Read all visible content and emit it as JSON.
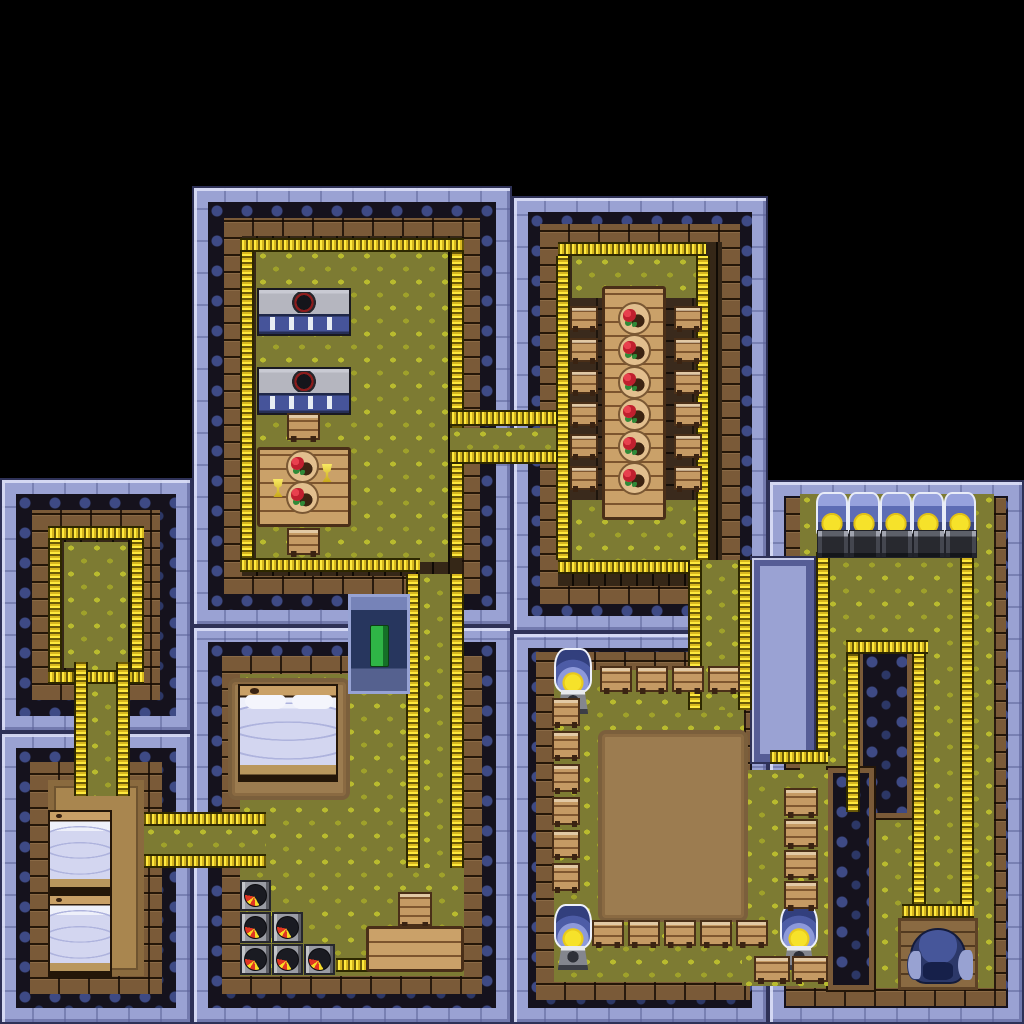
{
  "meta": {
    "app": "tile-rpg-interior-map",
    "description": "Top-down pixel-art interior of a multi-room building on black background",
    "canvas": {
      "width": 1024,
      "height": 1024,
      "background": "#000000"
    }
  },
  "palette": {
    "wall_light": "#9aa2d3",
    "wall_ornate_bg": "#15121d",
    "wall_ornate_swirl": "#3e4a85",
    "brick": "#7a5a38",
    "floor_shadow": "#352717",
    "floor_green": "#7d7b33",
    "leaf": "#b9bb2e",
    "fence_yellow": "#ffe93d",
    "wood": "#caa169",
    "floor_tan": "#a9864f",
    "stove_base_blue": "#46549a",
    "food_red": "#c01f2e",
    "food_green": "#2f8a38",
    "bed_sheet": "#d3d6f0",
    "flame_red": "#e03522",
    "flame_yellow": "#f7dc25",
    "lamp_glass": "#8d99da",
    "lamp_bulb": "#f6e22a",
    "book_green": "#2fb546",
    "throne_blue": "#2c3869"
  },
  "rooms": [
    {
      "id": "kitchen",
      "name": "kitchen-dining-room",
      "x": 192,
      "y": 186,
      "w": 320,
      "h": 440,
      "wall": [
        48,
        48,
        48,
        48
      ],
      "floor": "dark+green"
    },
    {
      "id": "dining",
      "name": "dining-hall",
      "x": 512,
      "y": 196,
      "w": 256,
      "h": 436,
      "wall": [
        44,
        44,
        44,
        44
      ],
      "floor": "dark+green"
    },
    {
      "id": "storage",
      "name": "small-storage-room",
      "x": 0,
      "y": 478,
      "w": 192,
      "h": 254,
      "wall": [
        48,
        48,
        48,
        48
      ],
      "floor": "dark+green"
    },
    {
      "id": "twinbeds",
      "name": "twin-bedroom",
      "x": 0,
      "y": 732,
      "w": 192,
      "h": 292,
      "wall": [
        46,
        46,
        46,
        46
      ],
      "floor": "tan"
    },
    {
      "id": "masterbed",
      "name": "master-bedroom",
      "x": 192,
      "y": 626,
      "w": 320,
      "h": 398,
      "wall": [
        46,
        46,
        46,
        46
      ],
      "floor": "green"
    },
    {
      "id": "dojo",
      "name": "training-hall",
      "x": 512,
      "y": 632,
      "w": 256,
      "h": 392,
      "wall": [
        36,
        22,
        40,
        40
      ],
      "floor": "green"
    },
    {
      "id": "machines",
      "name": "machine-room",
      "x": 768,
      "y": 480,
      "w": 256,
      "h": 544,
      "wall": [
        12,
        28,
        34,
        30
      ],
      "floor": "green"
    }
  ],
  "wall_patches": [
    {
      "name": "machine-room-west-wall",
      "cls": "wall-side",
      "x": 750,
      "y": 556,
      "w": 66,
      "h": 208
    },
    {
      "name": "interior-wall-pillar",
      "cls": "wall-patch",
      "x": 858,
      "y": 648,
      "w": 54,
      "h": 170
    },
    {
      "name": "interior-wall-band",
      "cls": "wall-patch",
      "x": 828,
      "y": 768,
      "w": 46,
      "h": 222
    }
  ],
  "floor_patches": [
    {
      "name": "dojo-east-wing-floor",
      "x": 742,
      "y": 770,
      "w": 86,
      "h": 216
    }
  ],
  "corridors": [
    {
      "name": "corridor-kitchen-to-dining-hall",
      "x": 450,
      "y": 428,
      "w": 112,
      "h": 22
    },
    {
      "name": "corridor-kitchen-to-master-bedroom",
      "x": 420,
      "y": 574,
      "w": 30,
      "h": 294
    },
    {
      "name": "corridor-dining-hall-to-dojo",
      "x": 702,
      "y": 560,
      "w": 36,
      "h": 150
    },
    {
      "name": "corridor-storage-to-twin-bedroom",
      "x": 88,
      "y": 662,
      "w": 28,
      "h": 134
    },
    {
      "name": "corridor-twin-bedroom-to-master-bedroom",
      "x": 144,
      "y": 826,
      "w": 122,
      "h": 28
    }
  ],
  "fences": [
    {
      "x": 240,
      "y": 238,
      "w": 224,
      "h": 14
    },
    {
      "x": 240,
      "y": 252,
      "w": 14,
      "h": 306
    },
    {
      "x": 450,
      "y": 252,
      "w": 14,
      "h": 176
    },
    {
      "x": 450,
      "y": 452,
      "w": 14,
      "h": 106
    },
    {
      "x": 240,
      "y": 558,
      "w": 180,
      "h": 14
    },
    {
      "x": 450,
      "y": 410,
      "w": 112,
      "h": 16
    },
    {
      "x": 450,
      "y": 450,
      "w": 112,
      "h": 14
    },
    {
      "x": 406,
      "y": 574,
      "w": 14,
      "h": 294
    },
    {
      "x": 450,
      "y": 574,
      "w": 14,
      "h": 294
    },
    {
      "x": 558,
      "y": 242,
      "w": 148,
      "h": 14
    },
    {
      "x": 556,
      "y": 256,
      "w": 14,
      "h": 304
    },
    {
      "x": 696,
      "y": 256,
      "w": 14,
      "h": 304
    },
    {
      "x": 558,
      "y": 560,
      "w": 142,
      "h": 14
    },
    {
      "x": 688,
      "y": 560,
      "w": 14,
      "h": 150
    },
    {
      "x": 738,
      "y": 560,
      "w": 14,
      "h": 150
    },
    {
      "x": 48,
      "y": 526,
      "w": 96,
      "h": 14
    },
    {
      "x": 48,
      "y": 540,
      "w": 14,
      "h": 130
    },
    {
      "x": 130,
      "y": 540,
      "w": 14,
      "h": 130
    },
    {
      "x": 48,
      "y": 670,
      "w": 96,
      "h": 14
    },
    {
      "x": 74,
      "y": 662,
      "w": 14,
      "h": 134
    },
    {
      "x": 116,
      "y": 662,
      "w": 14,
      "h": 134
    },
    {
      "x": 144,
      "y": 812,
      "w": 122,
      "h": 14
    },
    {
      "x": 144,
      "y": 854,
      "w": 122,
      "h": 14
    },
    {
      "x": 336,
      "y": 958,
      "w": 34,
      "h": 14
    },
    {
      "x": 816,
      "y": 552,
      "w": 14,
      "h": 204
    },
    {
      "x": 770,
      "y": 750,
      "w": 58,
      "h": 14
    },
    {
      "x": 960,
      "y": 552,
      "w": 14,
      "h": 372
    },
    {
      "x": 846,
      "y": 640,
      "w": 82,
      "h": 14
    },
    {
      "x": 846,
      "y": 654,
      "w": 14,
      "h": 158
    },
    {
      "x": 912,
      "y": 654,
      "w": 14,
      "h": 268
    },
    {
      "x": 902,
      "y": 904,
      "w": 72,
      "h": 14
    }
  ],
  "decor": [
    {
      "type": "darkwood",
      "name": "dining-hall-dark-floor",
      "x": 566,
      "y": 298,
      "w": 142,
      "h": 202
    },
    {
      "type": "rug",
      "name": "master-bed-rug",
      "x": 228,
      "y": 678,
      "w": 122,
      "h": 122
    },
    {
      "type": "arena",
      "name": "sparring-arena-dirt",
      "x": 598,
      "y": 730,
      "w": 150,
      "h": 192
    }
  ],
  "furniture": [
    {
      "type": "stove",
      "name": "stove-counter",
      "x": 257,
      "y": 288,
      "w": 94,
      "h": 48
    },
    {
      "type": "stove",
      "name": "stove-counter",
      "x": 257,
      "y": 367,
      "w": 94,
      "h": 48
    },
    {
      "type": "seat",
      "name": "chair",
      "x": 287,
      "y": 413,
      "w": 33,
      "h": 27
    },
    {
      "type": "wood",
      "name": "small-dining-table",
      "x": 257,
      "y": 447,
      "w": 94,
      "h": 80
    },
    {
      "type": "plate",
      "name": "plate-of-food",
      "x": 286,
      "y": 450,
      "w": 33,
      "h": 33
    },
    {
      "type": "plate",
      "name": "plate-of-food",
      "x": 286,
      "y": 481,
      "w": 33,
      "h": 33
    },
    {
      "type": "goblet",
      "name": "goblet",
      "x": 321,
      "y": 464,
      "w": 12,
      "h": 18
    },
    {
      "type": "goblet",
      "name": "goblet",
      "x": 272,
      "y": 479,
      "w": 12,
      "h": 18
    },
    {
      "type": "seat",
      "name": "chair",
      "x": 287,
      "y": 528,
      "w": 33,
      "h": 27
    },
    {
      "type": "wood",
      "name": "long-dining-table",
      "x": 602,
      "y": 286,
      "w": 64,
      "h": 234
    },
    {
      "type": "plate",
      "name": "plate-of-food",
      "x": 618,
      "y": 302,
      "w": 33,
      "h": 33
    },
    {
      "type": "plate",
      "name": "plate-of-food",
      "x": 618,
      "y": 334,
      "w": 33,
      "h": 33
    },
    {
      "type": "plate",
      "name": "plate-of-food",
      "x": 618,
      "y": 366,
      "w": 33,
      "h": 33
    },
    {
      "type": "plate",
      "name": "plate-of-food",
      "x": 618,
      "y": 398,
      "w": 33,
      "h": 33
    },
    {
      "type": "plate",
      "name": "plate-of-food",
      "x": 618,
      "y": 430,
      "w": 33,
      "h": 33
    },
    {
      "type": "plate",
      "name": "plate-of-food",
      "x": 618,
      "y": 462,
      "w": 33,
      "h": 33
    },
    {
      "type": "seat",
      "name": "stool",
      "x": 570,
      "y": 306,
      "w": 28,
      "h": 24
    },
    {
      "type": "seat",
      "name": "stool",
      "x": 570,
      "y": 338,
      "w": 28,
      "h": 24
    },
    {
      "type": "seat",
      "name": "stool",
      "x": 570,
      "y": 370,
      "w": 28,
      "h": 24
    },
    {
      "type": "seat",
      "name": "stool",
      "x": 570,
      "y": 402,
      "w": 28,
      "h": 24
    },
    {
      "type": "seat",
      "name": "stool",
      "x": 570,
      "y": 434,
      "w": 28,
      "h": 24
    },
    {
      "type": "seat",
      "name": "stool",
      "x": 570,
      "y": 466,
      "w": 28,
      "h": 24
    },
    {
      "type": "seat",
      "name": "stool",
      "x": 674,
      "y": 306,
      "w": 28,
      "h": 24
    },
    {
      "type": "seat",
      "name": "stool",
      "x": 674,
      "y": 338,
      "w": 28,
      "h": 24
    },
    {
      "type": "seat",
      "name": "stool",
      "x": 674,
      "y": 370,
      "w": 28,
      "h": 24
    },
    {
      "type": "seat",
      "name": "stool",
      "x": 674,
      "y": 402,
      "w": 28,
      "h": 24
    },
    {
      "type": "seat",
      "name": "stool",
      "x": 674,
      "y": 434,
      "w": 28,
      "h": 24
    },
    {
      "type": "seat",
      "name": "stool",
      "x": 674,
      "y": 466,
      "w": 28,
      "h": 24
    },
    {
      "type": "bed-s",
      "name": "single-bed",
      "x": 48,
      "y": 810,
      "w": 64,
      "h": 84
    },
    {
      "type": "bed-s",
      "name": "single-bed",
      "x": 48,
      "y": 894,
      "w": 64,
      "h": 84
    },
    {
      "type": "bed-b",
      "name": "double-bed",
      "x": 238,
      "y": 684,
      "w": 100,
      "h": 98
    },
    {
      "type": "case",
      "name": "display-case-green-book",
      "x": 348,
      "y": 594,
      "w": 62,
      "h": 100
    },
    {
      "type": "pot",
      "name": "fire-pot",
      "x": 240,
      "y": 880,
      "w": 31,
      "h": 31
    },
    {
      "type": "pot",
      "name": "fire-pot",
      "x": 240,
      "y": 912,
      "w": 31,
      "h": 31
    },
    {
      "type": "pot",
      "name": "fire-pot",
      "x": 272,
      "y": 912,
      "w": 31,
      "h": 31
    },
    {
      "type": "pot",
      "name": "fire-pot",
      "x": 240,
      "y": 944,
      "w": 31,
      "h": 31
    },
    {
      "type": "pot",
      "name": "fire-pot",
      "x": 272,
      "y": 944,
      "w": 31,
      "h": 31
    },
    {
      "type": "pot",
      "name": "fire-pot",
      "x": 304,
      "y": 944,
      "w": 31,
      "h": 31
    },
    {
      "type": "seat",
      "name": "step-stool",
      "x": 398,
      "y": 892,
      "w": 34,
      "h": 34
    },
    {
      "type": "wood",
      "name": "wooden-counter",
      "x": 366,
      "y": 926,
      "w": 98,
      "h": 46
    },
    {
      "type": "lamp",
      "name": "dome-lamp",
      "x": 554,
      "y": 648,
      "w": 38,
      "h": 66
    },
    {
      "type": "lamp",
      "name": "dome-lamp",
      "x": 554,
      "y": 904,
      "w": 38,
      "h": 66
    },
    {
      "type": "lamp",
      "name": "dome-lamp",
      "x": 780,
      "y": 904,
      "w": 38,
      "h": 66
    },
    {
      "type": "seat",
      "name": "bench",
      "x": 600,
      "y": 666,
      "w": 32,
      "h": 26
    },
    {
      "type": "seat",
      "name": "bench",
      "x": 636,
      "y": 666,
      "w": 32,
      "h": 26
    },
    {
      "type": "seat",
      "name": "bench",
      "x": 672,
      "y": 666,
      "w": 32,
      "h": 26
    },
    {
      "type": "seat",
      "name": "bench",
      "x": 708,
      "y": 666,
      "w": 32,
      "h": 26
    },
    {
      "type": "seat",
      "name": "bench",
      "x": 552,
      "y": 698,
      "w": 28,
      "h": 28
    },
    {
      "type": "seat",
      "name": "bench",
      "x": 552,
      "y": 731,
      "w": 28,
      "h": 28
    },
    {
      "type": "seat",
      "name": "bench",
      "x": 552,
      "y": 764,
      "w": 28,
      "h": 28
    },
    {
      "type": "seat",
      "name": "bench",
      "x": 552,
      "y": 797,
      "w": 28,
      "h": 28
    },
    {
      "type": "seat",
      "name": "bench",
      "x": 552,
      "y": 830,
      "w": 28,
      "h": 28
    },
    {
      "type": "seat",
      "name": "bench",
      "x": 552,
      "y": 863,
      "w": 28,
      "h": 28
    },
    {
      "type": "seat",
      "name": "bench",
      "x": 592,
      "y": 920,
      "w": 32,
      "h": 26
    },
    {
      "type": "seat",
      "name": "bench",
      "x": 628,
      "y": 920,
      "w": 32,
      "h": 26
    },
    {
      "type": "seat",
      "name": "bench",
      "x": 664,
      "y": 920,
      "w": 32,
      "h": 26
    },
    {
      "type": "seat",
      "name": "bench",
      "x": 700,
      "y": 920,
      "w": 32,
      "h": 26
    },
    {
      "type": "seat",
      "name": "bench",
      "x": 736,
      "y": 920,
      "w": 32,
      "h": 26
    },
    {
      "type": "seat",
      "name": "bench",
      "x": 784,
      "y": 788,
      "w": 34,
      "h": 28
    },
    {
      "type": "seat",
      "name": "bench",
      "x": 784,
      "y": 819,
      "w": 34,
      "h": 28
    },
    {
      "type": "seat",
      "name": "bench",
      "x": 784,
      "y": 850,
      "w": 34,
      "h": 28
    },
    {
      "type": "seat",
      "name": "bench",
      "x": 784,
      "y": 881,
      "w": 34,
      "h": 28
    },
    {
      "type": "seat",
      "name": "bench",
      "x": 754,
      "y": 956,
      "w": 36,
      "h": 26
    },
    {
      "type": "seat",
      "name": "bench",
      "x": 792,
      "y": 956,
      "w": 36,
      "h": 26
    },
    {
      "type": "machine",
      "name": "incubator-lamp-machine",
      "x": 816,
      "y": 492,
      "w": 32,
      "h": 66
    },
    {
      "type": "machine",
      "name": "incubator-lamp-machine",
      "x": 848,
      "y": 492,
      "w": 32,
      "h": 66
    },
    {
      "type": "machine",
      "name": "incubator-lamp-machine",
      "x": 880,
      "y": 492,
      "w": 32,
      "h": 66
    },
    {
      "type": "machine",
      "name": "incubator-lamp-machine",
      "x": 912,
      "y": 492,
      "w": 32,
      "h": 66
    },
    {
      "type": "machine",
      "name": "incubator-lamp-machine",
      "x": 944,
      "y": 492,
      "w": 32,
      "h": 66
    },
    {
      "type": "platform",
      "name": "throne-platform",
      "x": 898,
      "y": 918,
      "w": 80,
      "h": 72
    },
    {
      "type": "throne",
      "name": "throne-chair",
      "x": 910,
      "y": 928,
      "w": 56,
      "h": 56
    }
  ]
}
